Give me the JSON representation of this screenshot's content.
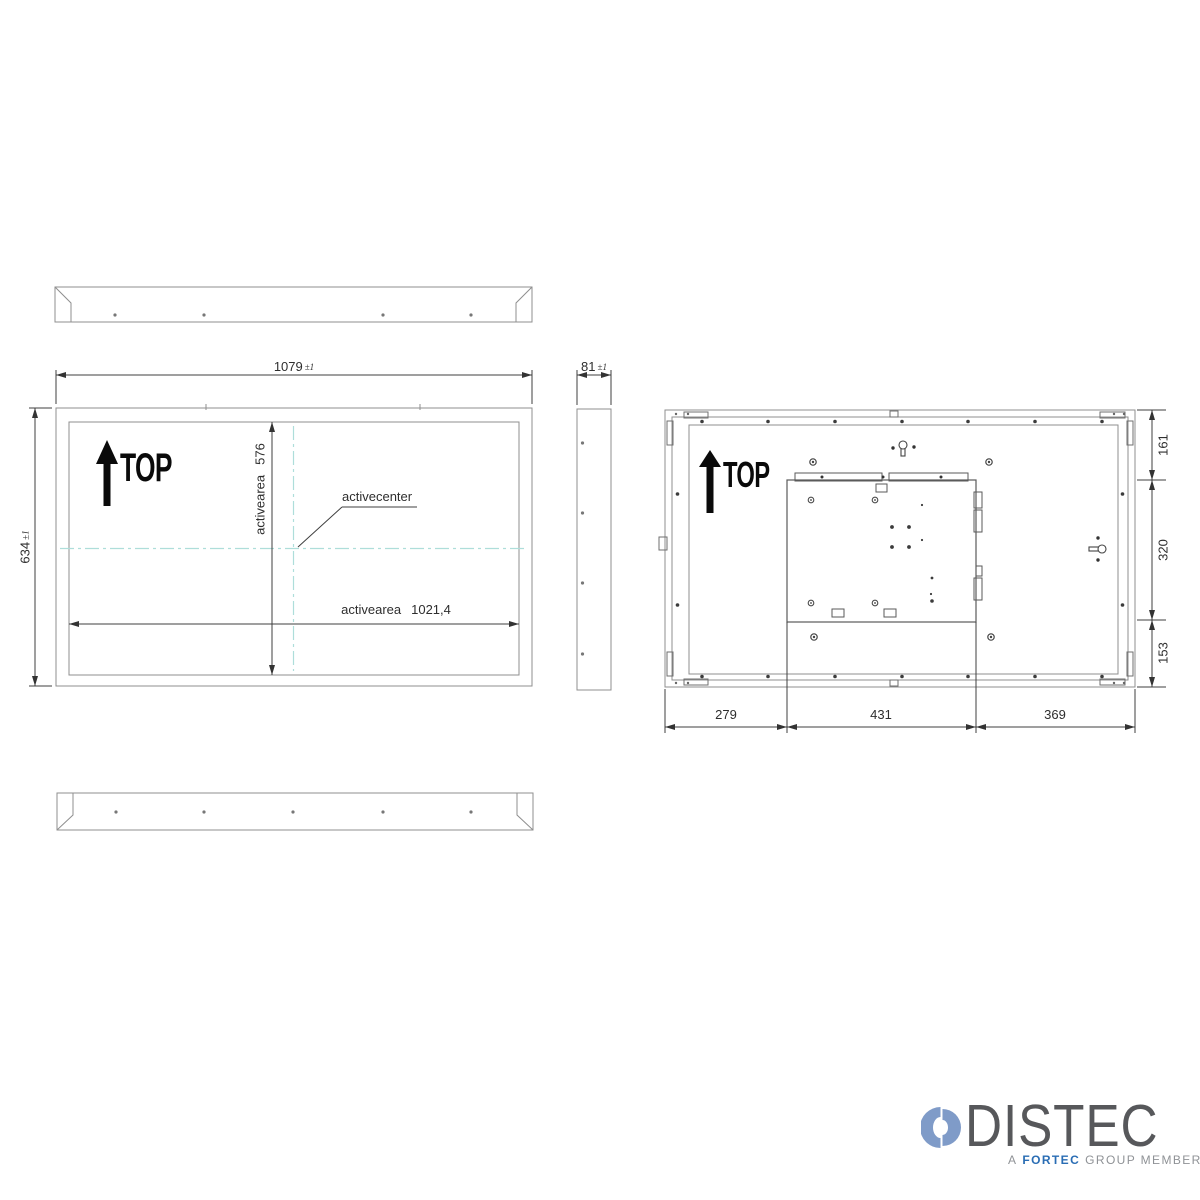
{
  "views": {
    "front": {
      "orientation_label": "TOP",
      "dim_width": {
        "value": "1079",
        "tol": "±1"
      },
      "dim_height": {
        "value": "634",
        "tol": "±1"
      },
      "active_height": {
        "label": "activearea",
        "value": "576"
      },
      "active_width": {
        "label": "activearea",
        "value": "1021,4"
      },
      "center_label": "activecenter"
    },
    "side": {
      "dim_width": {
        "value": "81",
        "tol": "±1"
      }
    },
    "rear": {
      "orientation_label": "TOP",
      "dims_right": [
        "161",
        "320",
        "153"
      ],
      "dims_bottom": [
        "279",
        "431",
        "369"
      ]
    }
  },
  "logo": {
    "brand": "DISTEC",
    "sub_prefix": "A",
    "sub_brand": "FORTEC",
    "sub_suffix": "GROUP MEMBER",
    "brand_color": "#57585b",
    "fortec_blue": "#2a6db4",
    "icon_blue": "#7f9bc8"
  },
  "colors": {
    "object_line": "#8f8f8f",
    "detail_line": "#5a5a5a",
    "dimension_line": "#3f3f3f",
    "centerline_teal": "#aededa"
  }
}
